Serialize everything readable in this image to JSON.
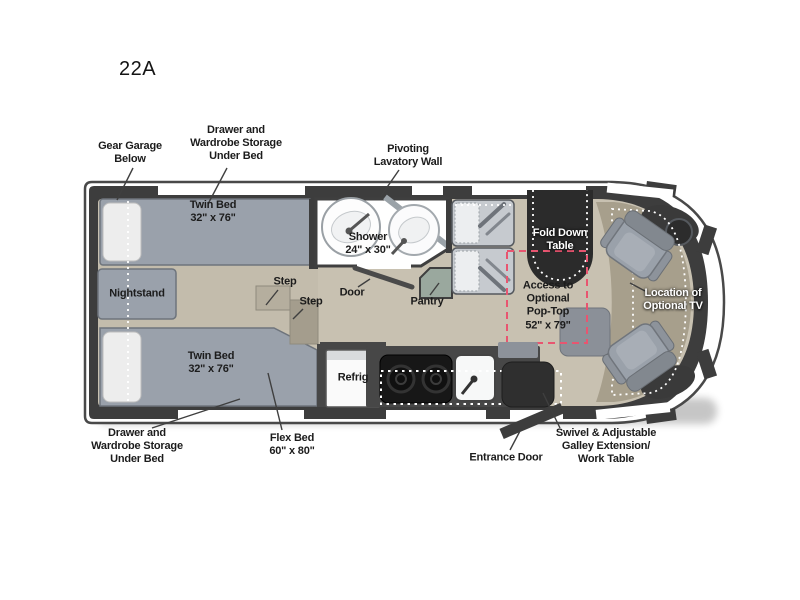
{
  "floorplan": {
    "model": "22A",
    "labels": {
      "gear_garage": "Gear Garage\nBelow",
      "storage_top": "Drawer and\nWardrobe Storage\nUnder Bed",
      "pivoting_lavatory": "Pivoting\nLavatory Wall",
      "twin_bed_top": "Twin Bed\n32\" x 76\"",
      "shower": "Shower\n24\" x 30\"",
      "fold_down_table": "Fold Down\nTable",
      "nightstand": "Nightstand",
      "step_1": "Step",
      "step_2": "Step",
      "door": "Door",
      "pantry": "Pantry",
      "pop_top": "Access to\nOptional\nPop-Top\n52\" x 79\"",
      "location_tv": "Location of\nOptional TV",
      "twin_bed_bottom": "Twin Bed\n32\" x 76\"",
      "refrig": "Refrig",
      "storage_bottom": "Drawer and\nWardrobe Storage\nUnder Bed",
      "flex_bed": "Flex Bed\n60\" x 80\"",
      "entrance_door": "Entrance Door",
      "swivel_table": "Swivel & Adjustable\nGalley Extension/\nWork Table"
    },
    "colors": {
      "wall": "#3d3d3d",
      "floor": "#c8c1b1",
      "cab_floor": "#a79f8c",
      "bed": "#9aa1ab",
      "table": "#2b2b2b",
      "pop_top_dash": "#e85570",
      "bg": "#ffffff",
      "label": "#1c1c1c"
    }
  }
}
